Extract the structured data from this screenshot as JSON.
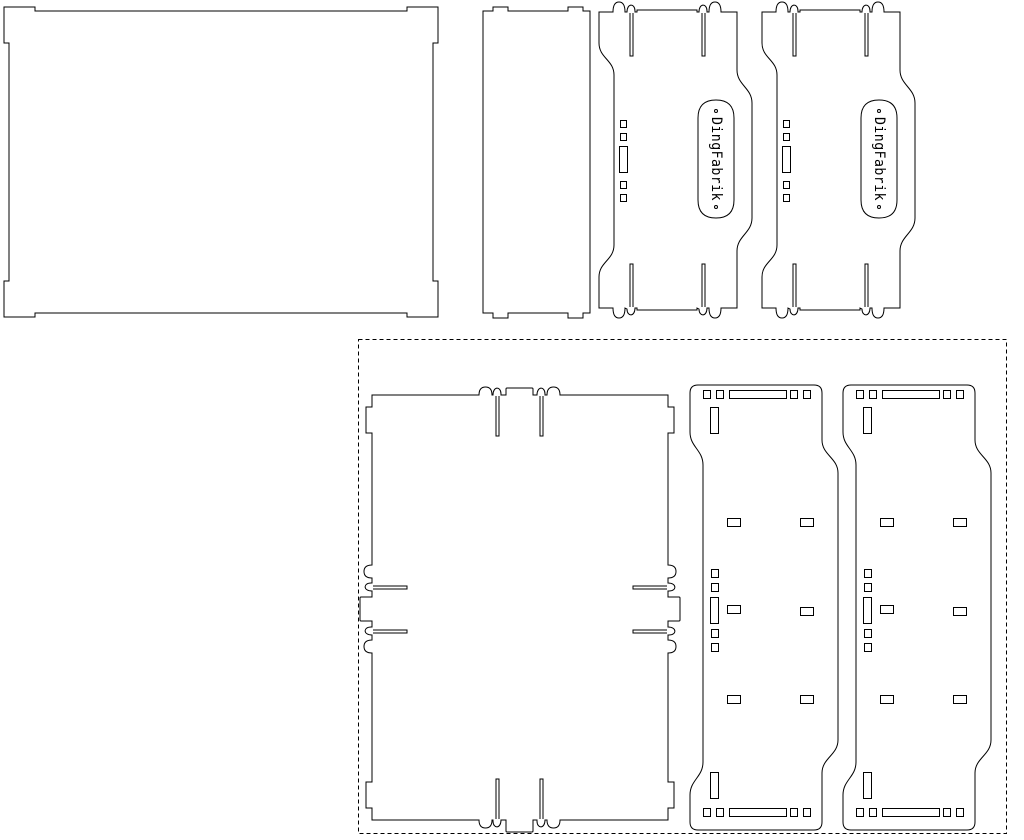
{
  "canvas": {
    "width": 1024,
    "height": 840,
    "background": "#ffffff",
    "stroke_color": "#000000",
    "stroke_width": 1
  },
  "sheet_border": {
    "x": 358,
    "y": 339,
    "width": 648,
    "height": 494,
    "dash": "4 3"
  },
  "engraving": {
    "label_text": "DingFabrik",
    "end_dot_radius": 1.5
  },
  "parts": [
    {
      "id": "lid-panel",
      "paths": [
        "M 4,7 L 35,7 L 35,11 L 407,11 L 407,7 L 438,7 L 438,43 L 433,43 L 433,281 L 438,281 L 438,317 L 407,317 L 407,313 L 35,313 L 35,317 L 4,317 L 4,281 L 9,281 L 9,43 L 4,43 Z"
      ],
      "rects": []
    },
    {
      "id": "small-plate",
      "paths": [
        "M 483,11 L 493,11 L 493,7 L 508,7 L 508,11 L 568,11 L 568,7 L 583,7 L 583,11 L 590,11 L 590,313 L 583,313 L 583,318 L 568,318 L 568,313 L 508,313 L 508,318 L 493,318 L 493,313 L 483,313 Z"
      ],
      "rects": []
    },
    {
      "id": "side-panel-a",
      "paths": [
        "M 599,12 L 613,12 Q 613,2 619,2 Q 625,2 625,12 L 627,12 C 627,3 635,3 635,11 L 635,12 L 637,12 L 637,10 L 697,10 L 697,12 L 699,12 C 699,3 707,3 707,11 L 707,12 L 709,12 Q 709,2 715,2 Q 721,2 721,12 L 737,12 L 737,70 C 737,85 752,88 752,103 L 752,218 C 752,233 737,236 737,251 L 737,308 L 721,308 Q 721,318 715,318 Q 709,318 709,308 L 707,308 C 707,317 699,317 699,309 L 697,308 L 697,310 L 637,310 L 637,308 L 635,308 C 635,317 627,317 627,309 L 625,308 Q 625,318 619,318 Q 613,318 613,308 L 599,308 L 599,277 C 599,262 614,260 614,245 L 614,75 C 614,60 599,58 599,43 Z",
        "M 630,13 L 630,56 L 633,56 L 633,13",
        "M 702,13 L 702,56 L 705,56 L 705,13",
        "M 630,307 L 630,264 L 633,264 L 633,307",
        "M 702,307 L 702,264 L 705,264 L 705,307"
      ],
      "rects": [
        [
          620,
          120,
          6,
          7
        ],
        [
          620,
          133,
          6,
          7
        ],
        [
          619,
          146,
          8,
          26
        ],
        [
          620,
          181,
          6,
          7
        ],
        [
          620,
          194,
          6,
          7
        ]
      ],
      "label": {
        "pill": "M 698,200 L 698,118 Q 698,100 716,100 Q 734,100 734,118 L 734,200 Q 734,218 716,218 Q 698,218 698,200 Z",
        "cx": 716,
        "cy": 159,
        "rotate": 90,
        "text_length": 84,
        "dot1": [
          716,
          111
        ],
        "dot2": [
          716,
          207
        ]
      }
    },
    {
      "id": "side-panel-b",
      "same_as": "side-panel-a",
      "dx": 163,
      "dy": 0
    },
    {
      "id": "base-panel",
      "paths": [
        "M 372,395 L 479,395 Q 479,387 485.5,387 Q 492,387 492,395 L 493,395 C 493,386 501,386 501,394 L 501,395 L 506,395 L 506,389 Q 506,388 507,388 L 532,388 Q 533,388 533,389 L 533,395 L 537,395 C 537,386 545,386 545,394 L 545,395 L 547,395 Q 547,387 553.5,387 Q 560,387 560,395 L 668,395 L 668,407 L 674,407 L 674,433 L 668,433 L 668,565 Q 676,565 676,571.5 Q 676,578 668,578 L 668,583 C 677,583 677,591 669,591 L 668,591 L 668,597 L 679,597 Q 680,597 680,598 L 680,620 Q 680,621 679,621 L 668,621 L 668,627 C 677,627 677,635 669,635 L 668,635 L 668,640 Q 676,640 676,646.5 Q 676,653 668,653 L 668,782 L 674,782 L 674,808 L 668,808 L 668,820 L 560,820 Q 560,828 553.5,828 Q 547,828 547,820 L 545,820 C 545,829 537,829 537,821 L 537,820 L 533,820 L 533,831 Q 533,832 532,832 L 507,832 Q 506,832 506,831 L 506,820 L 501,820 C 501,829 493,829 493,821 L 493,820 L 492,820 Q 492,828 485.5,828 Q 479,828 479,820 L 372,820 L 372,808 L 366,808 L 366,782 L 372,782 L 372,653 Q 364,653 364,646.5 Q 364,640 372,640 L 372,635 C 363,635 363,627 371,627 L 372,627 L 372,621 L 361,621 Q 360,621 360,620 L 360,598 Q 360,597 361,597 L 372,597 L 372,591 C 363,591 363,583 371,583 L 372,583 L 372,578 Q 364,578 364,571.5 Q 364,565 372,565 L 372,433 L 366,433 L 366,407 L 372,407 Z",
        "M 496,396 L 496,436 L 499,436 L 499,396",
        "M 540,396 L 540,436 L 543,436 L 543,396",
        "M 496,819 L 496,779 L 499,779 L 499,819",
        "M 540,819 L 540,779 L 543,779 L 543,819",
        "M 373,586 L 407,586 L 407,589 L 373,589",
        "M 373,630 L 407,630 L 407,633 L 373,633",
        "M 667,586 L 633,586 L 633,589 L 667,589",
        "M 667,630 L 633,630 L 633,633 L 667,633"
      ],
      "rects": []
    },
    {
      "id": "slotted-panel-a",
      "paths": [
        "M 698,385 L 814,385 Q 822,385 822,393 L 822,440 C 822,455 838,458 838,473 L 838,740 C 838,755 822,758 822,773 L 822,822 Q 822,830 814,830 L 698,830 Q 690,830 690,822 L 690,795 C 690,780 703,777 703,762 L 703,465 C 703,450 690,447 690,432 L 690,393 Q 690,385 698,385 Z"
      ],
      "rects": [
        [
          703,
          390,
          7,
          8
        ],
        [
          716,
          390,
          7,
          8
        ],
        [
          729,
          390,
          57,
          8
        ],
        [
          790,
          390,
          7,
          8
        ],
        [
          803,
          390,
          7,
          8
        ],
        [
          710,
          407,
          8,
          26
        ],
        [
          727,
          518,
          13,
          8
        ],
        [
          800,
          518,
          13,
          8
        ],
        [
          711,
          569,
          7,
          8
        ],
        [
          711,
          583,
          7,
          8
        ],
        [
          710,
          597,
          8,
          26
        ],
        [
          711,
          629,
          7,
          8
        ],
        [
          711,
          643,
          7,
          8
        ],
        [
          727,
          605,
          13,
          8
        ],
        [
          800,
          607,
          13,
          8
        ],
        [
          727,
          695,
          13,
          8
        ],
        [
          800,
          695,
          13,
          8
        ],
        [
          710,
          772,
          8,
          26
        ],
        [
          703,
          808,
          7,
          8
        ],
        [
          716,
          808,
          7,
          8
        ],
        [
          729,
          808,
          57,
          8
        ],
        [
          790,
          808,
          7,
          8
        ],
        [
          803,
          808,
          7,
          8
        ]
      ]
    },
    {
      "id": "slotted-panel-b",
      "same_as": "slotted-panel-a",
      "dx": 153,
      "dy": 0
    }
  ]
}
